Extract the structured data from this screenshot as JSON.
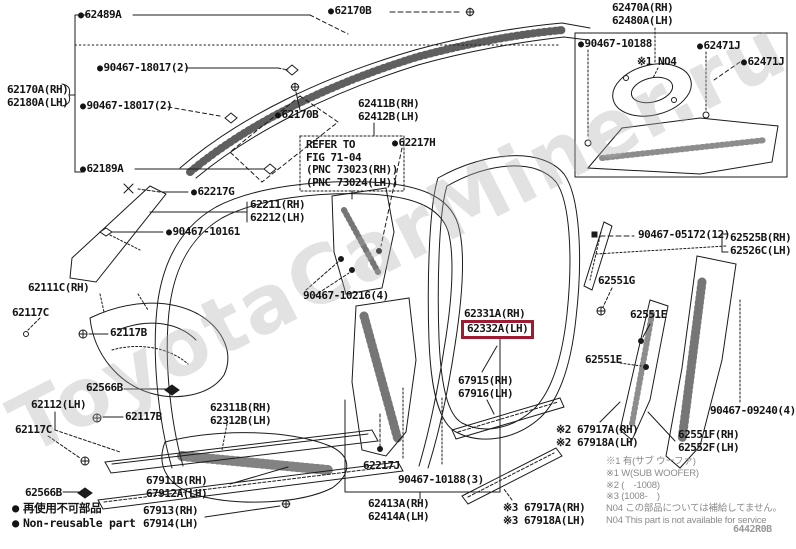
{
  "page": {
    "watermark": "ToyotaCarMiner.ru",
    "doc_code": "6442R0B"
  },
  "highlight": {
    "part": "62332A(LH)",
    "color": "#9e1b32"
  },
  "legend": {
    "jp": "再使用不可部品",
    "en": "Non-reusable part"
  },
  "footnotes": [
    "※1 有(サブ ウーファ)",
    "※1 W(SUB WOOFER)",
    "※2 (　-1008)",
    "※3 (1008-　)",
    "N04 この部品については補給してません。",
    "N04 This part is not available for service"
  ],
  "labels": [
    {
      "id": "62489a",
      "lines": [
        "62489A"
      ],
      "bullet": true,
      "x": 78,
      "y": 9
    },
    {
      "id": "62170b-top",
      "lines": [
        "62170B"
      ],
      "bullet": true,
      "x": 328,
      "y": 5
    },
    {
      "id": "62470a-62480a",
      "lines": [
        "62470A(RH)",
        "62480A(LH)"
      ],
      "bullet": false,
      "x": 612,
      "y": 2
    },
    {
      "id": "90467-10188",
      "lines": [
        "90467-10188"
      ],
      "bullet": true,
      "x": 578,
      "y": 38
    },
    {
      "id": "62471j-inner",
      "lines": [
        "62471J"
      ],
      "bullet": true,
      "x": 697,
      "y": 40
    },
    {
      "id": "62471j-outer",
      "lines": [
        "62471J"
      ],
      "bullet": true,
      "x": 741,
      "y": 56
    },
    {
      "id": "no4-mark",
      "lines": [
        "※1 NO4"
      ],
      "bullet": false,
      "note": true,
      "x": 637,
      "y": 56
    },
    {
      "id": "90467-18017-1",
      "lines": [
        "90467-18017(2)"
      ],
      "bullet": true,
      "x": 97,
      "y": 62
    },
    {
      "id": "62170a-62180a",
      "lines": [
        "62170A(RH)",
        "62180A(LH)"
      ],
      "bullet": false,
      "x": 7,
      "y": 84
    },
    {
      "id": "90467-18017-2",
      "lines": [
        "90467-18017(2)"
      ],
      "bullet": true,
      "x": 80,
      "y": 100
    },
    {
      "id": "62170b-2",
      "lines": [
        "62170B"
      ],
      "bullet": true,
      "x": 275,
      "y": 109
    },
    {
      "id": "62411b-62412b",
      "lines": [
        "62411B(RH)",
        "62412B(LH)"
      ],
      "bullet": false,
      "x": 358,
      "y": 98
    },
    {
      "id": "62217h",
      "lines": [
        "62217H"
      ],
      "bullet": true,
      "x": 392,
      "y": 137
    },
    {
      "id": "refer-note",
      "lines": [
        "REFER TO",
        "FIG 71-04",
        "(PNC 73023(RH))",
        "(PNC 73024(LH))"
      ],
      "bullet": false,
      "note": true,
      "x": 306,
      "y": 139
    },
    {
      "id": "62189a",
      "lines": [
        "62189A"
      ],
      "bullet": true,
      "x": 80,
      "y": 163
    },
    {
      "id": "62217g",
      "lines": [
        "62217G"
      ],
      "bullet": true,
      "x": 191,
      "y": 186
    },
    {
      "id": "62211-62212",
      "lines": [
        "62211(RH)",
        "62212(LH)"
      ],
      "bullet": false,
      "x": 250,
      "y": 199
    },
    {
      "id": "90467-10161",
      "lines": [
        "90467-10161"
      ],
      "bullet": true,
      "x": 166,
      "y": 226
    },
    {
      "id": "90467-05172",
      "lines": [
        "90467-05172(12)"
      ],
      "bullet": false,
      "x": 638,
      "y": 229
    },
    {
      "id": "62525b-62526c",
      "lines": [
        "62525B(RH)",
        "62526C(LH)"
      ],
      "bullet": false,
      "x": 730,
      "y": 232
    },
    {
      "id": "62111c",
      "lines": [
        "62111C(RH)"
      ],
      "bullet": false,
      "x": 28,
      "y": 282
    },
    {
      "id": "62117c-1",
      "lines": [
        "62117C"
      ],
      "bullet": false,
      "x": 12,
      "y": 307
    },
    {
      "id": "62117b-1",
      "lines": [
        "62117B"
      ],
      "bullet": false,
      "x": 110,
      "y": 327
    },
    {
      "id": "90467-10216",
      "lines": [
        "90467-10216(4)"
      ],
      "bullet": false,
      "x": 303,
      "y": 290
    },
    {
      "id": "62331a",
      "lines": [
        "62331A(RH)"
      ],
      "bullet": false,
      "x": 464,
      "y": 308
    },
    {
      "id": "62332a",
      "lines": [
        "62332A(LH)"
      ],
      "bullet": false,
      "highlighted": true,
      "x": 461,
      "y": 320
    },
    {
      "id": "62551g-1",
      "lines": [
        "62551G"
      ],
      "bullet": false,
      "x": 598,
      "y": 275
    },
    {
      "id": "62551e-1",
      "lines": [
        "62551E"
      ],
      "bullet": false,
      "x": 630,
      "y": 309
    },
    {
      "id": "62566b-1",
      "lines": [
        "62566B"
      ],
      "bullet": false,
      "x": 86,
      "y": 382
    },
    {
      "id": "62112",
      "lines": [
        "62112(LH)"
      ],
      "bullet": false,
      "x": 31,
      "y": 399
    },
    {
      "id": "62117b-2",
      "lines": [
        "62117B"
      ],
      "bullet": false,
      "x": 125,
      "y": 411
    },
    {
      "id": "62117c-2",
      "lines": [
        "62117C"
      ],
      "bullet": false,
      "x": 15,
      "y": 424
    },
    {
      "id": "67915-67916",
      "lines": [
        "67915(RH)",
        "67916(LH)"
      ],
      "bullet": false,
      "x": 458,
      "y": 375
    },
    {
      "id": "62551e-2",
      "lines": [
        "62551E"
      ],
      "bullet": false,
      "x": 585,
      "y": 354
    },
    {
      "id": "62311b-62312b",
      "lines": [
        "62311B(RH)",
        "62312B(LH)"
      ],
      "bullet": false,
      "x": 210,
      "y": 402
    },
    {
      "id": "90467-09240",
      "lines": [
        "90467-09240(4)"
      ],
      "bullet": false,
      "x": 710,
      "y": 405
    },
    {
      "id": "62551f-62552f",
      "lines": [
        "62551F(RH)",
        "62552F(LH)"
      ],
      "bullet": false,
      "x": 678,
      "y": 429
    },
    {
      "id": "67917a-67918a-n2",
      "lines": [
        "※2 67917A(RH)",
        "※2 67918A(LH)"
      ],
      "bullet": false,
      "x": 556,
      "y": 424
    },
    {
      "id": "62566b-2",
      "lines": [
        "62566B"
      ],
      "bullet": false,
      "x": 25,
      "y": 487
    },
    {
      "id": "67911b-67912a",
      "lines": [
        "67911B(RH)",
        "67912A(LH)"
      ],
      "bullet": false,
      "x": 146,
      "y": 475
    },
    {
      "id": "67913-67914",
      "lines": [
        "67913(RH)",
        "67914(LH)"
      ],
      "bullet": false,
      "x": 143,
      "y": 505
    },
    {
      "id": "62217j",
      "lines": [
        "62217J"
      ],
      "bullet": false,
      "x": 363,
      "y": 460
    },
    {
      "id": "90467-10188-3",
      "lines": [
        "90467-10188(3)"
      ],
      "bullet": false,
      "x": 398,
      "y": 474
    },
    {
      "id": "62413a-62414a",
      "lines": [
        "62413A(RH)",
        "62414A(LH)"
      ],
      "bullet": false,
      "x": 368,
      "y": 498
    },
    {
      "id": "67917a-67918a-n3",
      "lines": [
        "※3 67917A(RH)",
        "※3 67918A(LH)"
      ],
      "bullet": false,
      "x": 503,
      "y": 502
    }
  ]
}
